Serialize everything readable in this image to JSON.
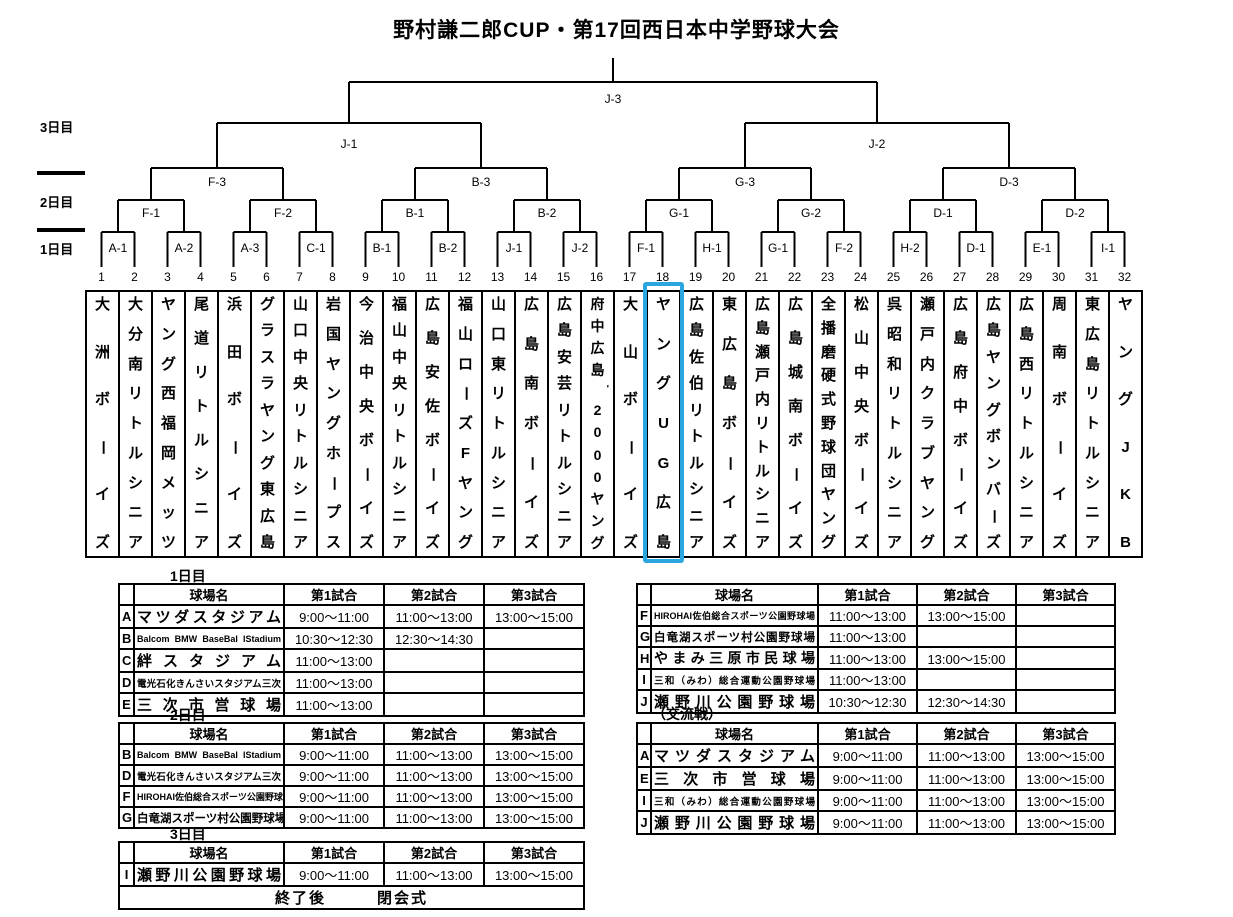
{
  "title": "野村謙二郎CUP・第17回西日本中学野球大会",
  "bracket": {
    "day_labels": [
      "3日目",
      "2日目",
      "1日目"
    ],
    "rounds": {
      "final": [
        "J-3"
      ],
      "semifinal": [
        "J-1",
        "J-2"
      ],
      "quarterfinal": [
        "F-3",
        "B-3",
        "G-3",
        "D-3"
      ],
      "round2": [
        "F-1",
        "F-2",
        "B-1",
        "B-2",
        "G-1",
        "G-2",
        "D-1",
        "D-2"
      ],
      "round1": [
        "A-1",
        "A-2",
        "A-3",
        "C-1",
        "B-1",
        "B-2",
        "J-1",
        "J-2",
        "F-1",
        "H-1",
        "G-1",
        "F-2",
        "H-2",
        "D-1",
        "E-1",
        "I-1"
      ]
    },
    "slot_numbers": [
      1,
      2,
      3,
      4,
      5,
      6,
      7,
      8,
      9,
      10,
      11,
      12,
      13,
      14,
      15,
      16,
      17,
      18,
      19,
      20,
      21,
      22,
      23,
      24,
      25,
      26,
      27,
      28,
      29,
      30,
      31,
      32
    ],
    "teams": [
      "大洲ボーイズ",
      "大分南リトルシニア",
      "ヤング西福岡メッツ",
      "尾道リトルシニア",
      "浜田ボーイズ",
      "グラスラヤング東広島",
      "山口中央リトルシニア",
      "岩国ヤングホープス",
      "今治中央ボーイズ",
      "福山中央リトルシニア",
      "広島安佐ボーイズ",
      "福山ローズFヤング",
      "山口東リトルシニア",
      "広島南ボーイズ",
      "広島安芸リトルシニア",
      "府中広島'2000ヤング",
      "大山ボーイズ",
      "ヤングUG広島",
      "広島佐伯リトルシニア",
      "東広島ボーイズ",
      "広島瀬戸内リトルシニア",
      "広島城南ボーイズ",
      "全播磨硬式野球団ヤング",
      "松山中央ボーイズ",
      "呉昭和リトルシニア",
      "瀬戸内クラブヤング",
      "広島府中ボーイズ",
      "広島ヤングボンバーズ",
      "広島西リトルシニア",
      "周南ボーイズ",
      "東広島リトルシニア",
      "ヤングJKB"
    ],
    "highlight": {
      "team_no": 18,
      "team_name": "ヤングUG広島",
      "color": "#2CA6DF"
    }
  },
  "schedule": {
    "column_headers": [
      "球場名",
      "第1試合",
      "第2試合",
      "第3試合"
    ],
    "tables": [
      {
        "title": "1日目",
        "rows": [
          [
            "A",
            "マツダスタジアム",
            "9:00～11:00",
            "11:00～13:00",
            "13:00～15:00"
          ],
          [
            "B",
            "Balcom BMW BaseBal lStadium",
            "10:30～12:30",
            "12:30～14:30",
            ""
          ],
          [
            "C",
            "絆スタジアム",
            "11:00～13:00",
            "",
            ""
          ],
          [
            "D",
            "電光石化きんさいスタジアム三次",
            "11:00～13:00",
            "",
            ""
          ],
          [
            "E",
            "三次市営球場",
            "11:00～13:00",
            "",
            ""
          ]
        ]
      },
      {
        "title": "",
        "rows": [
          [
            "F",
            "HIROHAI佐伯総合スポーツ公園野球場",
            "11:00～13:00",
            "13:00～15:00",
            ""
          ],
          [
            "G",
            "白竜湖スポーツ村公園野球場",
            "11:00～13:00",
            "",
            ""
          ],
          [
            "H",
            "やまみ三原市民球場",
            "11:00～13:00",
            "13:00～15:00",
            ""
          ],
          [
            "I",
            "三和（みわ）総合運動公園野球場",
            "11:00～13:00",
            "",
            ""
          ],
          [
            "J",
            "瀬野川公園野球場",
            "10:30～12:30",
            "12:30～14:30",
            ""
          ]
        ]
      },
      {
        "title": "2日目",
        "rows": [
          [
            "B",
            "Balcom BMW BaseBal lStadium",
            "9:00～11:00",
            "11:00～13:00",
            "13:00～15:00"
          ],
          [
            "D",
            "電光石化きんさいスタジアム三次",
            "9:00～11:00",
            "11:00～13:00",
            "13:00～15:00"
          ],
          [
            "F",
            "HIROHAI佐伯総合スポーツ公園野球場",
            "9:00～11:00",
            "11:00～13:00",
            "13:00～15:00"
          ],
          [
            "G",
            "白竜湖スポーツ村公園野球場",
            "9:00～11:00",
            "11:00～13:00",
            "13:00～15:00"
          ]
        ]
      },
      {
        "title": "（交流戦）",
        "rows": [
          [
            "A",
            "マツダスタジアム",
            "9:00～11:00",
            "11:00～13:00",
            "13:00～15:00"
          ],
          [
            "E",
            "三次市営球場",
            "9:00～11:00",
            "11:00～13:00",
            "13:00～15:00"
          ],
          [
            "I",
            "三和（みわ）総合運動公園野球場",
            "9:00～11:00",
            "11:00～13:00",
            "13:00～15:00"
          ],
          [
            "J",
            "瀬野川公園野球場",
            "9:00～11:00",
            "11:00～13:00",
            "13:00～15:00"
          ]
        ]
      },
      {
        "title": "3日目",
        "rows": [
          [
            "I",
            "瀬野川公園野球場",
            "9:00～11:00",
            "11:00～13:00",
            "13:00～15:00"
          ]
        ],
        "footer": "終了後　　　閉会式"
      }
    ]
  }
}
